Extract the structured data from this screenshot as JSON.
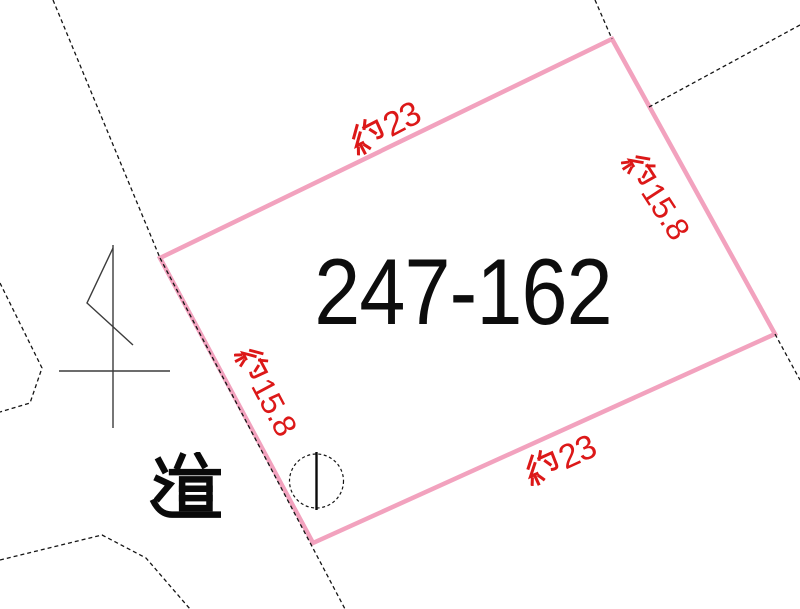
{
  "page": {
    "width": 800,
    "height": 609,
    "background": "#ffffff",
    "description_label": "land parcel map"
  },
  "parcel": {
    "id_label": "247-162",
    "boundary_color": "#f2a2be",
    "dimension_color": "#dc1818",
    "dimensions": {
      "top": {
        "label": "約23",
        "kanji_prefix": "約",
        "value": "23"
      },
      "right": {
        "label": "約15.8",
        "kanji_prefix": "約",
        "value": "15.8"
      },
      "bottom": {
        "label": "約23",
        "kanji_prefix": "約",
        "value": "23"
      },
      "left": {
        "label": "約15.8",
        "kanji_prefix": "約",
        "value": "15.8"
      }
    }
  },
  "road": {
    "label": "道"
  },
  "icons": {
    "circle_marker": "circle-marker-icon",
    "pole_symbol": "pole-mark-icon",
    "kanji_yaku": "kanji-yaku-icon",
    "kanji_michi": "kanji-michi-icon"
  }
}
